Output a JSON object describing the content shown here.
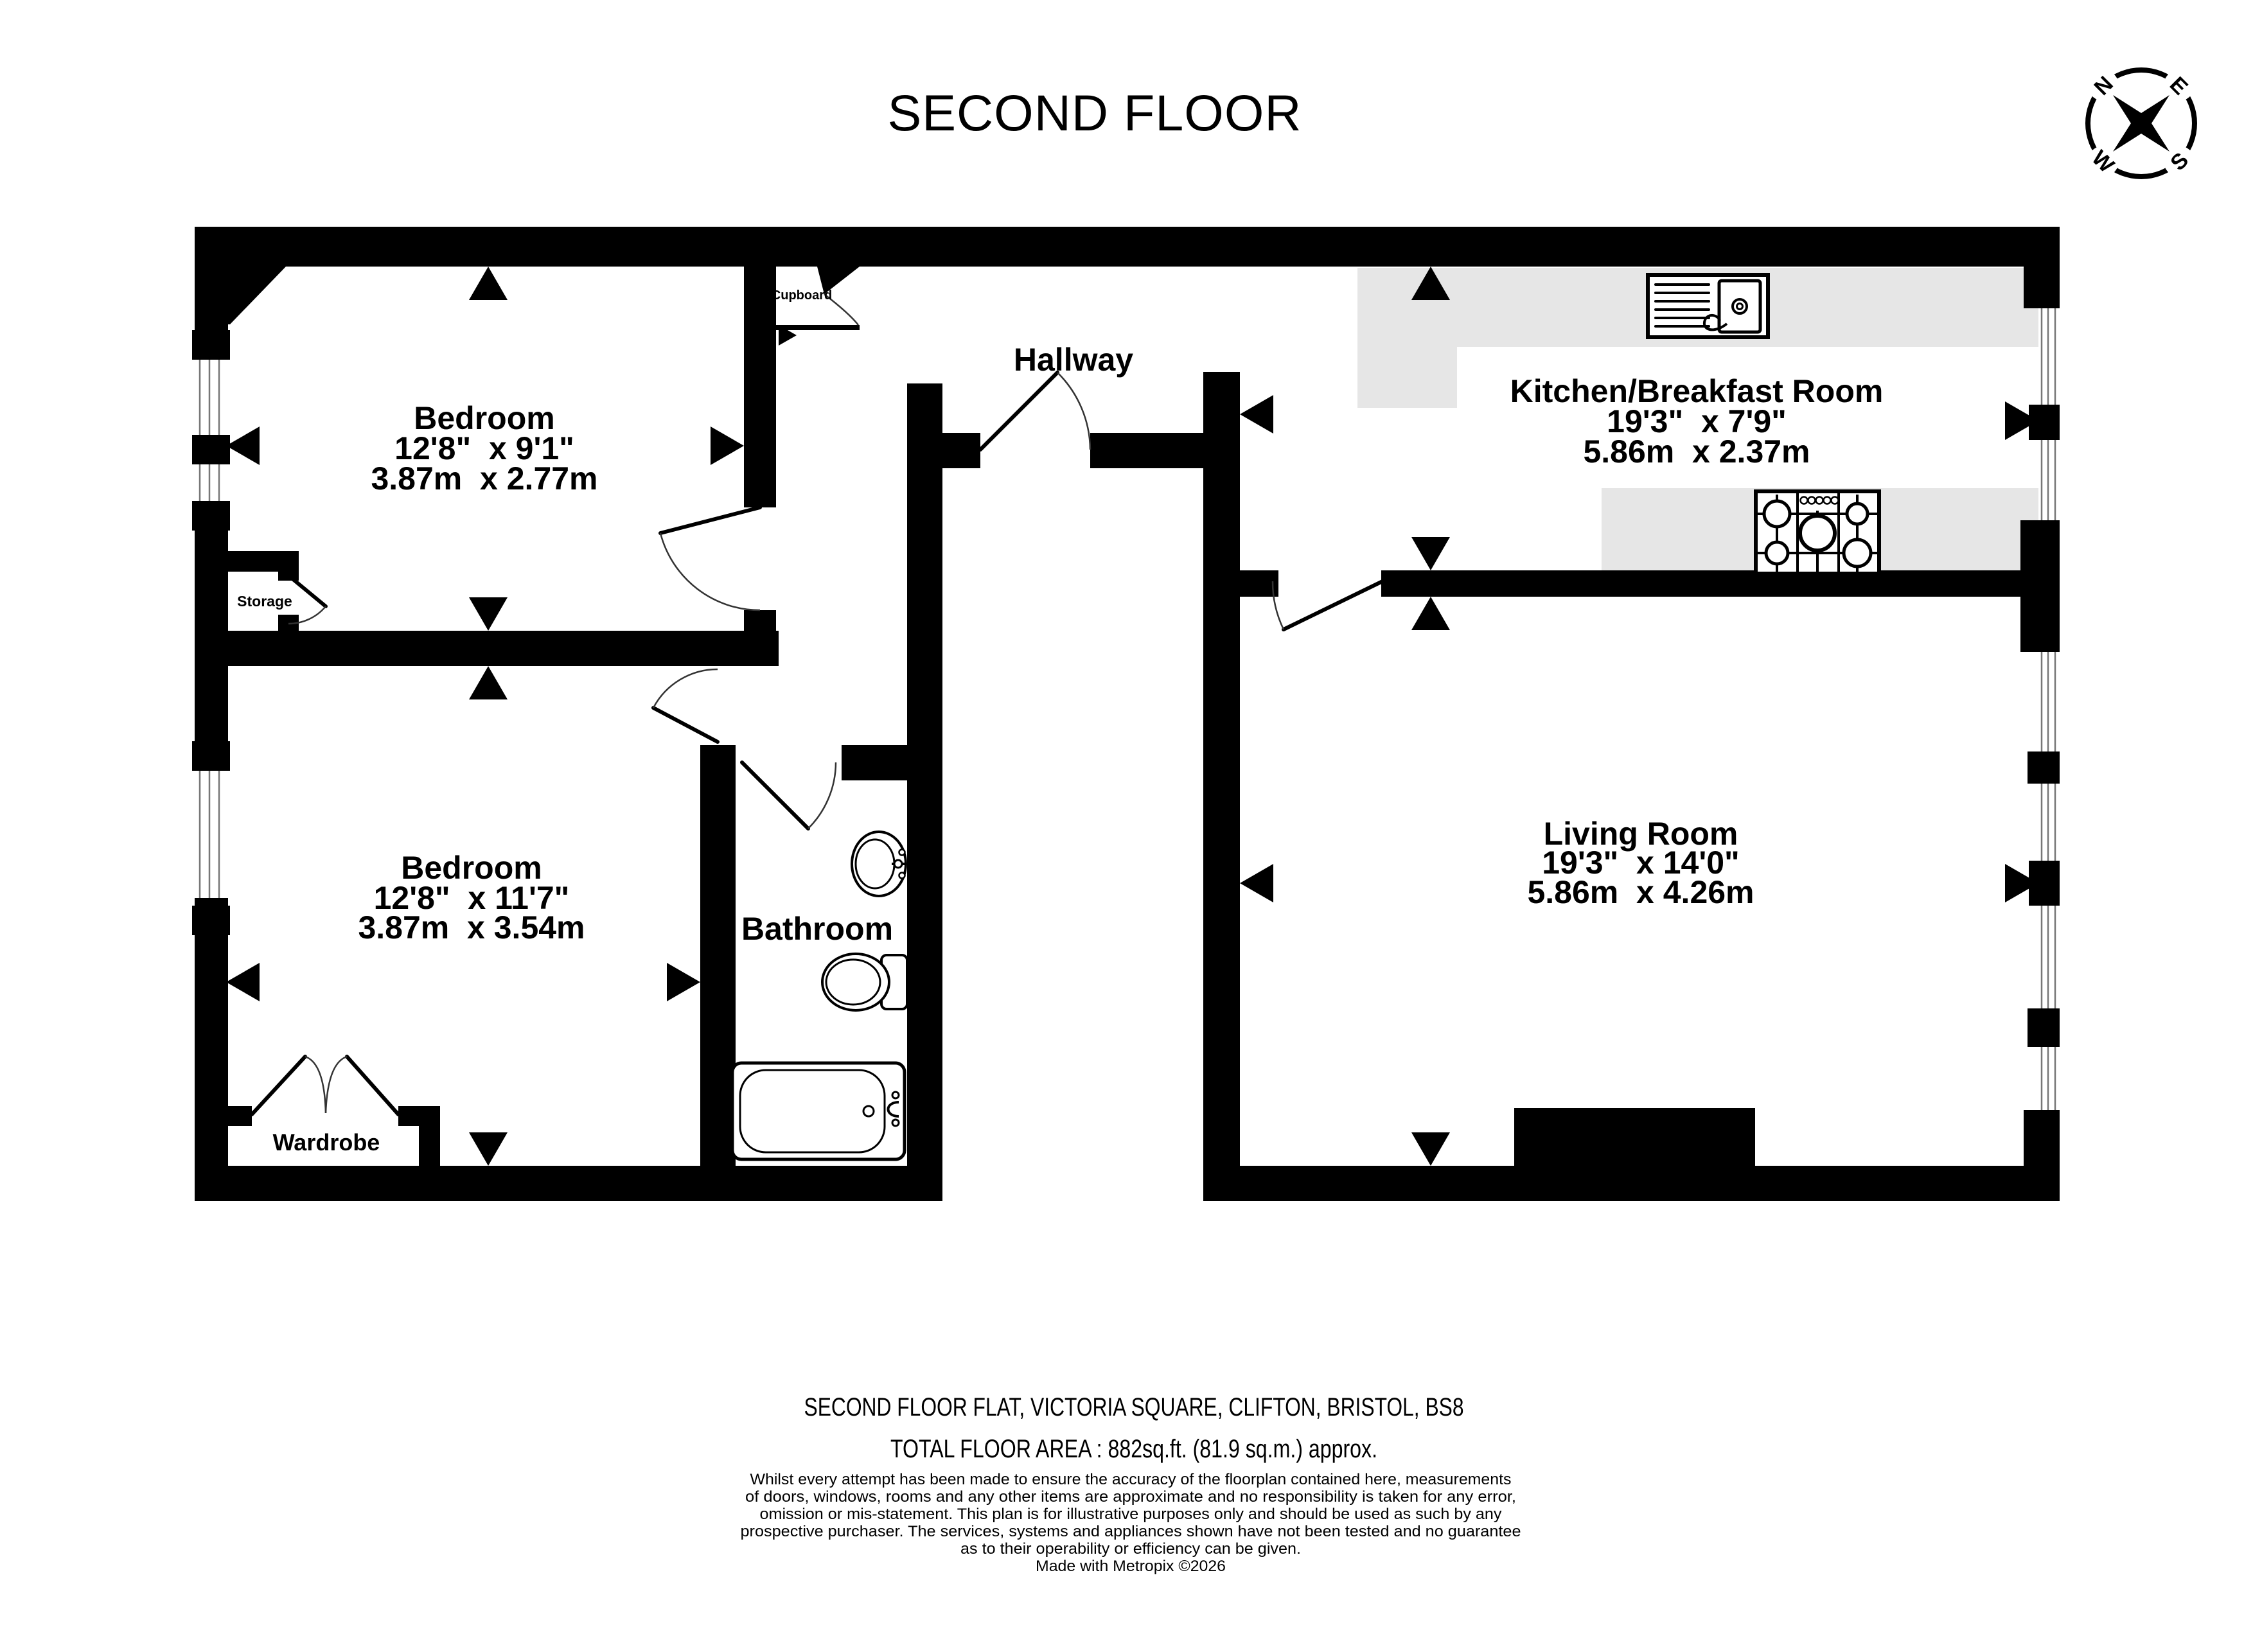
{
  "title": "SECOND FLOOR",
  "compass": {
    "n": "N",
    "e": "E",
    "s": "S",
    "w": "W"
  },
  "rooms": {
    "bedroom1": {
      "name": "Bedroom",
      "imperial": "12'8\"  x 9'1\"",
      "metric": "3.87m  x 2.77m"
    },
    "bedroom2": {
      "name": "Bedroom",
      "imperial": "12'8\"  x 11'7\"",
      "metric": "3.87m  x 3.54m"
    },
    "kitchen": {
      "name": "Kitchen/Breakfast Room",
      "imperial": "19'3\"  x 7'9\"",
      "metric": "5.86m  x 2.37m"
    },
    "living": {
      "name": "Living Room",
      "imperial": "19'3\"  x 14'0\"",
      "metric": "5.86m  x 4.26m"
    },
    "hallway": {
      "name": "Hallway"
    },
    "bathroom": {
      "name": "Bathroom"
    },
    "storage": {
      "name": "Storage"
    },
    "wardrobe": {
      "name": "Wardrobe"
    },
    "cupboard": {
      "name": "Cupboard"
    }
  },
  "footer": {
    "address": "SECOND FLOOR FLAT, VICTORIA SQUARE, CLIFTON, BRISTOL, BS8",
    "total_area": "TOTAL FLOOR AREA : 882sq.ft. (81.9 sq.m.) approx.",
    "disclaimer": [
      "Whilst every attempt has been made to ensure the accuracy of the floorplan contained here, measurements",
      "of doors, windows, rooms and any other items are approximate and no responsibility is taken for any error,",
      "omission or mis-statement. This plan is for illustrative purposes only and should be used as such by any",
      "prospective purchaser. The services, systems and appliances shown have not been tested and no guarantee",
      "as to their operability or efficiency can be given."
    ],
    "credit": "Made with Metropix ©2026"
  },
  "colors": {
    "wall": "#000000",
    "counter": "#e6e6e6",
    "background": "#ffffff"
  }
}
